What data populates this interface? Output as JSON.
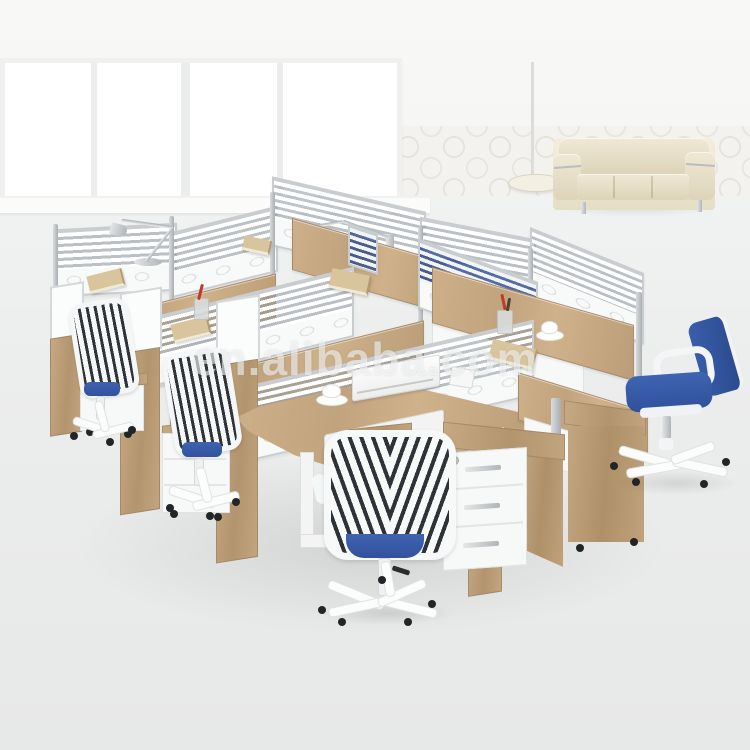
{
  "meta": {
    "type": "product-photograph",
    "description": "Showroom photo of a six-seat modular office workstation cluster with aluminum-framed glass partition screens, melamine wood desktops, white task chairs with blue seats, a blue side chair, three-drawer mobile pedestals, clamp desk lamps, a cream leather sofa, patterned wallpaper and a large window."
  },
  "watermark": {
    "text": "en.alibaba.com"
  },
  "palette": {
    "floor": "#eceded",
    "wall": "#f6f6f4",
    "window_frame": "#ededeb",
    "wallpaper_motif": "#e4e2dd",
    "desk_wood": "#c8ab84",
    "panel_aluminum": "#c9cdd0",
    "panel_white": "#f8f9f9",
    "glass_stripe_gray": "#8e98a0",
    "glass_stripe_blue": "#2c4a8c",
    "chair_blue": "#3a5ea9",
    "chair_stripe_dark": "#2f343a",
    "sofa_cream": "#ede6d0",
    "caster_black": "#222527",
    "pen_red": "#c0392b",
    "book_tan": "#d9c59d"
  },
  "objects": {
    "background": [
      "window",
      "wallpaper-wall",
      "showroom-floor"
    ],
    "lounge": [
      "cream-leather-sofa",
      "floor-lamp"
    ],
    "workstations": [
      "glass-partition-screens",
      "l-shaped-wood-desks",
      "keyboard-tray",
      "mobile-pedestals"
    ],
    "seating": [
      "white-task-chair-1",
      "white-task-chair-2",
      "white-task-chair-front",
      "blue-task-chair-right"
    ],
    "accessories": [
      "desk-lamp-left",
      "desk-lamp-right",
      "books",
      "pen-cups",
      "coffee-cups",
      "laptop",
      "smartphone"
    ]
  }
}
